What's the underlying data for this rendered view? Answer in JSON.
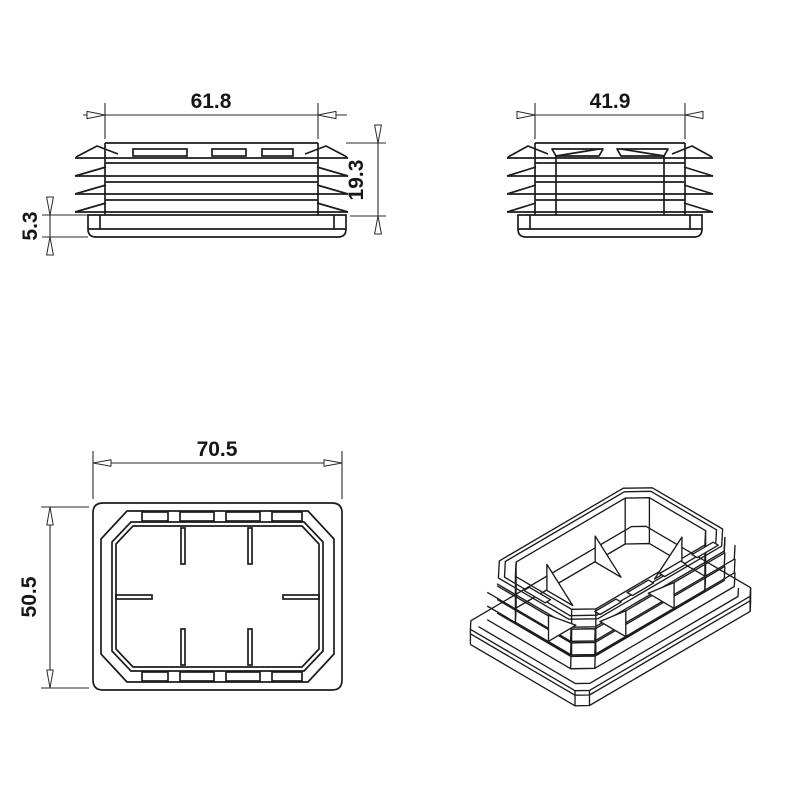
{
  "meta": {
    "background": "#ffffff",
    "line_color": "#1c1c1c",
    "dim_line_color": "#2a2a2a",
    "text_color": "#161616"
  },
  "views": {
    "front": {
      "title": "front-view",
      "width_label": "61.8",
      "insert_depth_label": "19.3",
      "flange_height_label": "5.3"
    },
    "side": {
      "title": "side-view",
      "width_label": "41.9"
    },
    "top": {
      "title": "top-view",
      "width_label": "70.5",
      "height_label": "50.5"
    },
    "iso": {
      "title": "isometric-view"
    }
  }
}
